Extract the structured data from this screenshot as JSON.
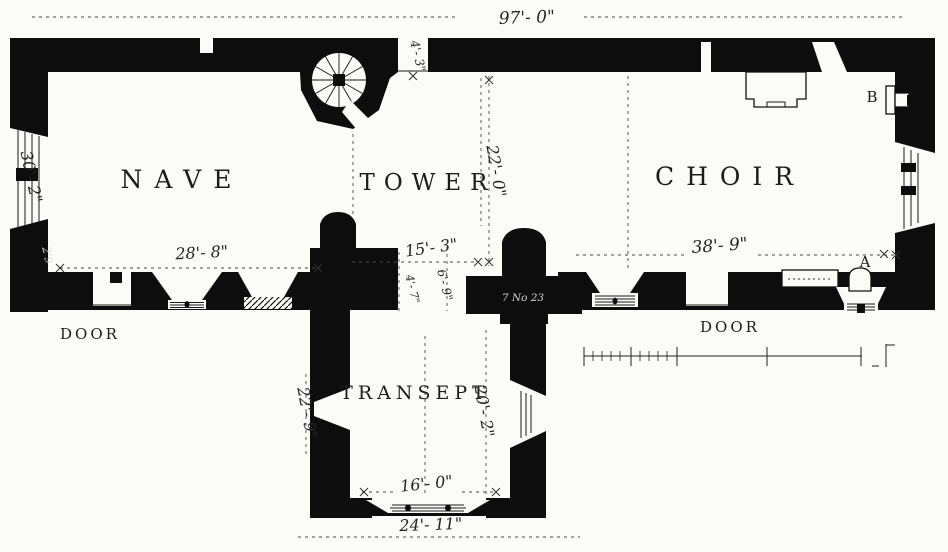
{
  "rooms": {
    "nave": "NAVE",
    "tower": "TOWER",
    "choir": "CHOIR",
    "transept": "TRANSEPT"
  },
  "dims": {
    "overall_length": "97'- 0\"",
    "nave_length": "28'- 8\"",
    "nave_width": "30'- 2\"",
    "tower_length": "15'- 3\"",
    "tower_width": "22'- 0\"",
    "choir_length": "38'- 9\"",
    "transept_west": "22'- 9\"",
    "transept_east": "20'- 2\"",
    "transept_inner_width": "16'- 0\"",
    "transept_outer_width": "24'- 11\"",
    "stair_passage": "4'- 3\"",
    "crossing_west": "4'- 7\"",
    "crossing_east": "6'- 9\"",
    "wall_thickness_note": "2'9"
  },
  "labels": {
    "door_nave": "DOOR",
    "door_choir": "DOOR",
    "ref_a": "A",
    "ref_b": "B",
    "pier_note": "7 No 23"
  },
  "colors": {
    "ink": "#0d0d0d",
    "paper": "#fbfbf8",
    "dimension_line": "#4a4a4a"
  }
}
